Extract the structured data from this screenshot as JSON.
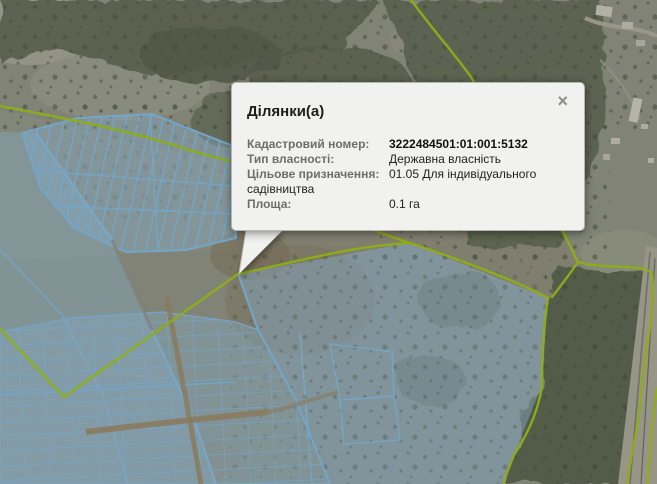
{
  "popup": {
    "title": "Ділянки(а)",
    "close_icon": "×",
    "rows": [
      {
        "label": "Кадастровий номер:",
        "value": "3222484501:01:001:5132"
      },
      {
        "label": "Тип власності:",
        "value": "Державна власність"
      },
      {
        "label": "Цільове призначення:",
        "value": "01.05 Для індивідуального садівництва"
      },
      {
        "label": "Площа:",
        "value": "0.1 га"
      }
    ]
  },
  "colors": {
    "parcel_line": "#8ac6f0",
    "parcel_fill": "#9ecdef",
    "boundary_line": "#abd119",
    "popup_bg": "#f1f1ef",
    "popup_title": "#1c1c1c",
    "popup_label": "#6d6d6d",
    "popup_value": "#222222",
    "close_icon": "#8b8b8b"
  }
}
